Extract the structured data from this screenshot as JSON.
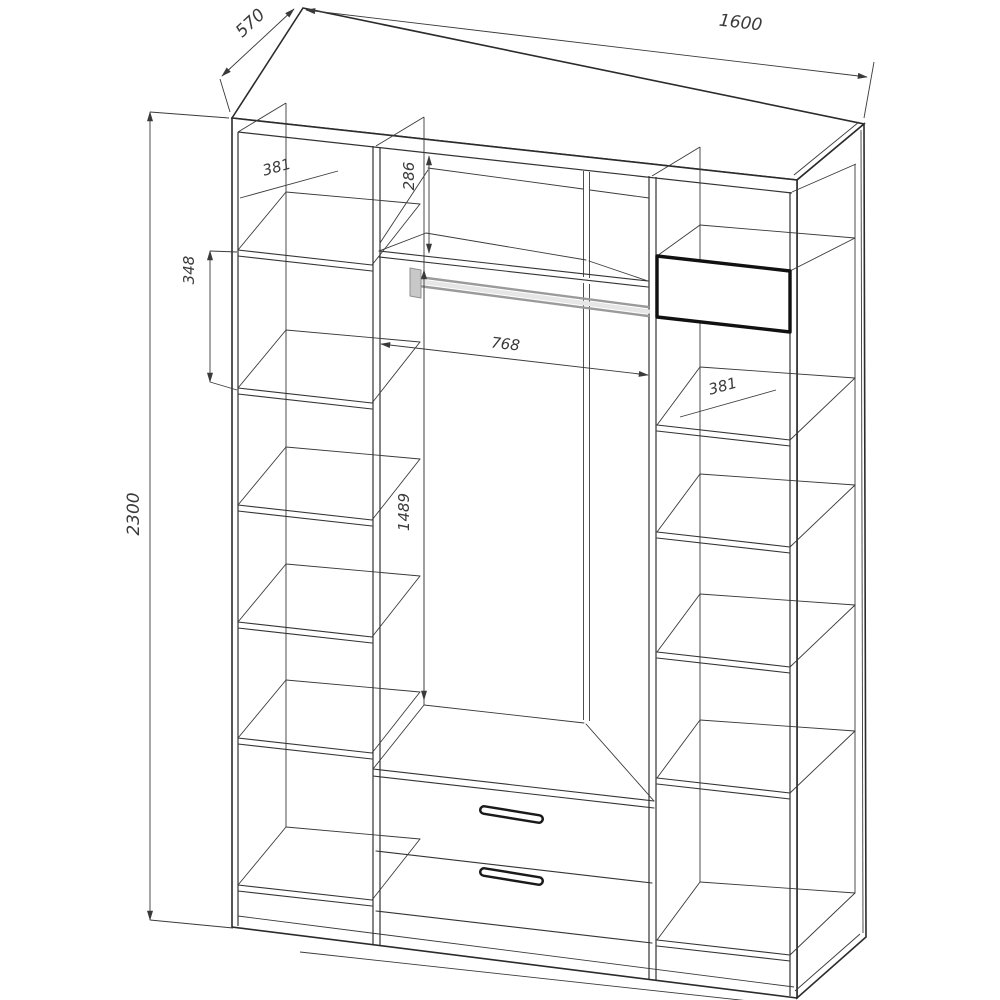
{
  "drawing": {
    "subject": "wardrobe cutaway technical drawing",
    "units": "mm",
    "line_color": "#333333",
    "rod_color": "#c8c8c8",
    "dims": {
      "overall_width": "1600",
      "overall_depth": "570",
      "overall_height": "2300",
      "left_top_cubby_height": "381",
      "left_second_cubby_height": "348",
      "center_top_cubby_height": "286",
      "hanging_bay_width": "768",
      "hanging_bay_height": "1489",
      "right_cubby_height": "381"
    }
  }
}
